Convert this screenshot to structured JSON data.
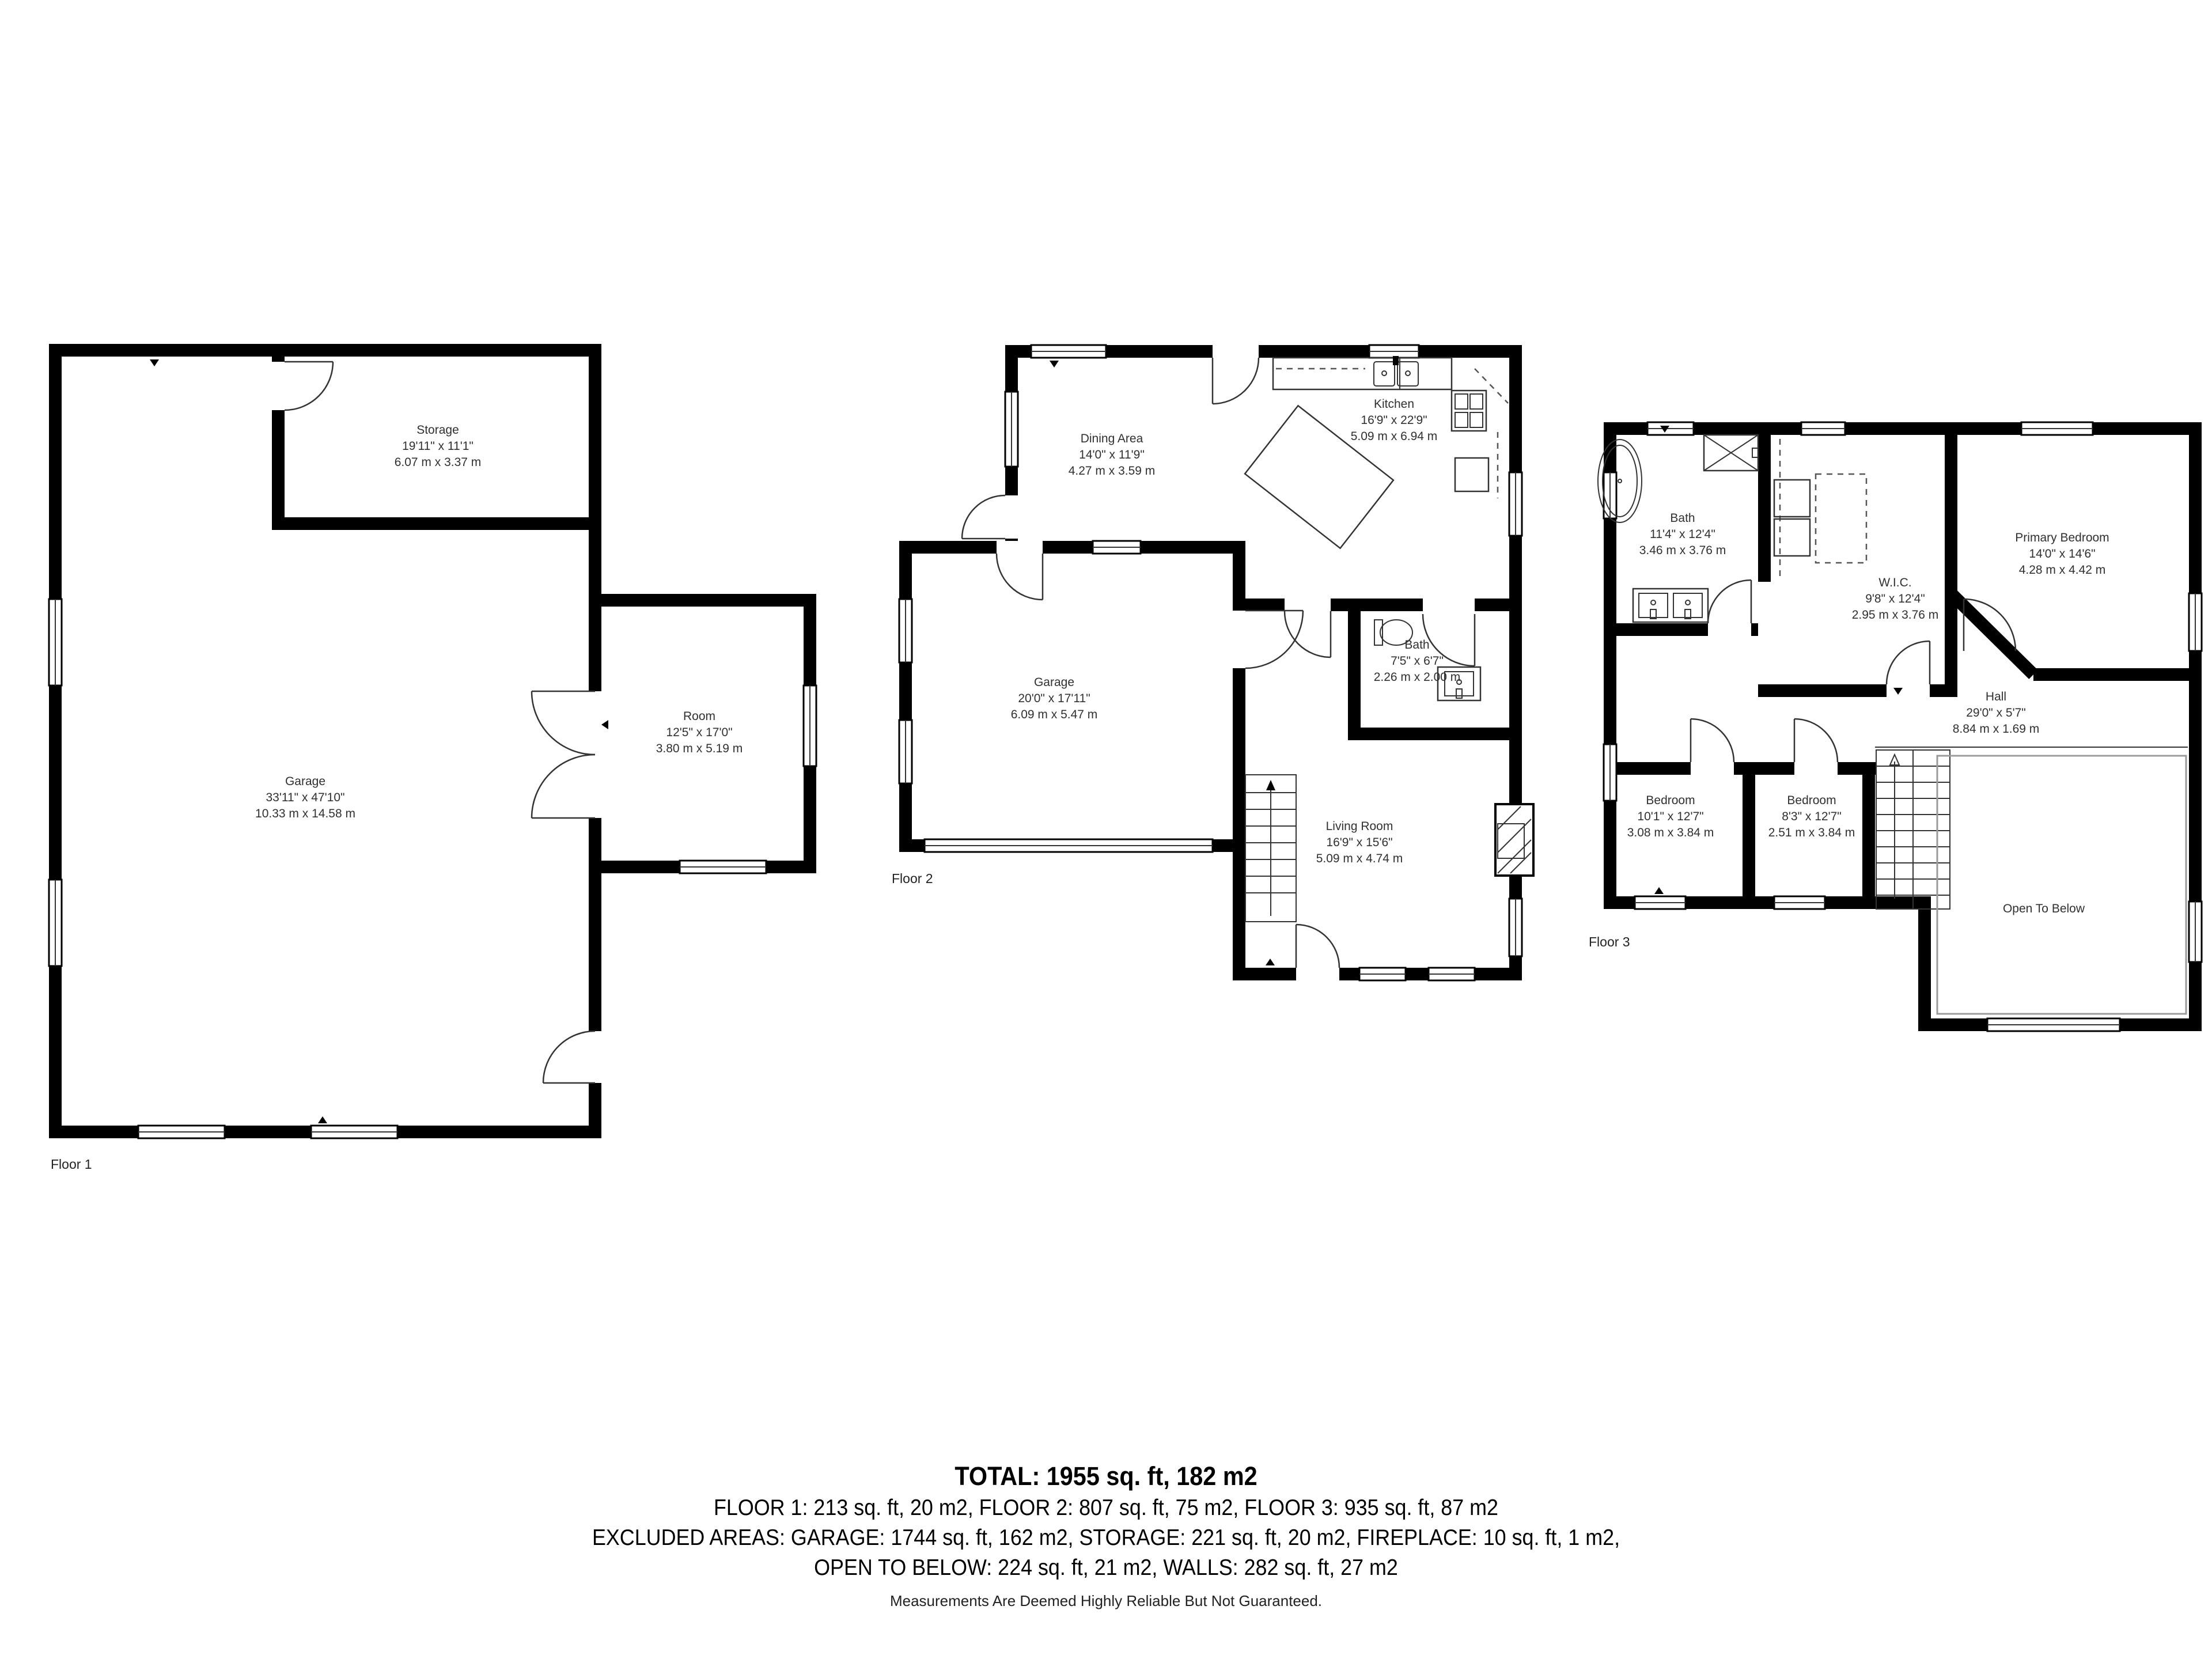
{
  "floors": [
    {
      "label": "Floor 1",
      "rooms": [
        {
          "name": "Storage",
          "imperial": "19'11\" x 11'1\"",
          "metric": "6.07 m x 3.37 m"
        },
        {
          "name": "Garage",
          "imperial": "33'11\" x 47'10\"",
          "metric": "10.33 m x 14.58 m"
        },
        {
          "name": "Room",
          "imperial": "12'5\" x 17'0\"",
          "metric": "3.80 m x 5.19 m"
        }
      ]
    },
    {
      "label": "Floor 2",
      "rooms": [
        {
          "name": "Dining Area",
          "imperial": "14'0\" x 11'9\"",
          "metric": "4.27 m x 3.59 m"
        },
        {
          "name": "Kitchen",
          "imperial": "16'9\" x 22'9\"",
          "metric": "5.09 m x 6.94 m"
        },
        {
          "name": "Garage",
          "imperial": "20'0\" x 17'11\"",
          "metric": "6.09 m x 5.47 m"
        },
        {
          "name": "Bath",
          "imperial": "7'5\" x 6'7\"",
          "metric": "2.26 m x 2.00 m"
        },
        {
          "name": "Living Room",
          "imperial": "16'9\" x 15'6\"",
          "metric": "5.09 m x 4.74 m"
        }
      ]
    },
    {
      "label": "Floor 3",
      "rooms": [
        {
          "name": "Bath",
          "imperial": "11'4\" x 12'4\"",
          "metric": "3.46 m x 3.76 m"
        },
        {
          "name": "W.I.C.",
          "imperial": "9'8\" x 12'4\"",
          "metric": "2.95 m x 3.76 m"
        },
        {
          "name": "Primary Bedroom",
          "imperial": "14'0\" x 14'6\"",
          "metric": "4.28 m x 4.42 m"
        },
        {
          "name": "Hall",
          "imperial": "29'0\" x 5'7\"",
          "metric": "8.84 m x 1.69 m"
        },
        {
          "name": "Bedroom",
          "imperial": "10'1\" x 12'7\"",
          "metric": "3.08 m x 3.84 m"
        },
        {
          "name": "Bedroom",
          "imperial": "8'3\" x 12'7\"",
          "metric": "2.51 m x 3.84 m"
        },
        {
          "name": "Open To Below"
        }
      ]
    }
  ],
  "summary": {
    "total": "TOTAL: 1955 sq. ft, 182 m2",
    "floors_line": "FLOOR 1: 213 sq. ft, 20 m2, FLOOR 2: 807 sq. ft, 75 m2, FLOOR 3: 935 sq. ft, 87 m2",
    "excluded_line1": "EXCLUDED AREAS: GARAGE: 1744 sq. ft, 162 m2, STORAGE: 221 sq. ft, 20 m2, FIREPLACE: 10 sq. ft, 1 m2,",
    "excluded_line2": "OPEN TO BELOW: 224 sq. ft, 21 m2, WALLS: 282 sq. ft, 27 m2",
    "disclaimer": "Measurements Are Deemed Highly Reliable But Not Guaranteed."
  }
}
